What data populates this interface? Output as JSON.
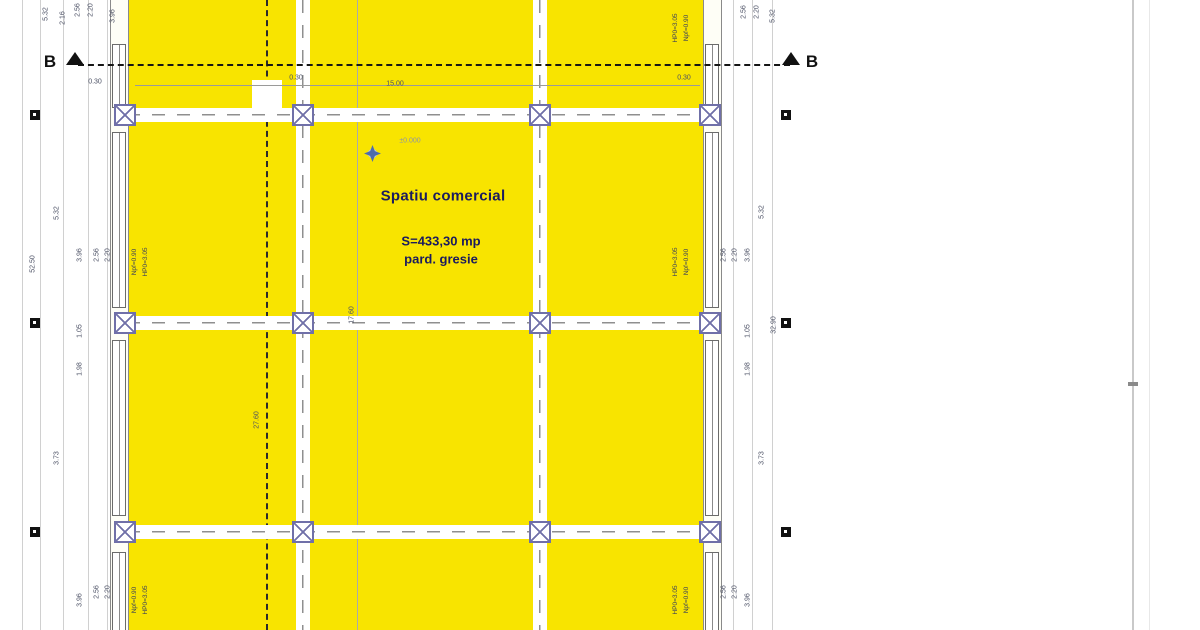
{
  "drawing": {
    "type": "architectural floor plan",
    "colors": {
      "room_fill": "#f8e400",
      "column_stroke": "#7070a8",
      "label_navy": "#1b1b5e",
      "dim_text": "#4a4f63",
      "marker_black": "#111111"
    }
  },
  "section": {
    "label": "B"
  },
  "room": {
    "name": "Spatiu comercial",
    "area": "S=433,30 mp",
    "flooring": "pard. gresie",
    "level": "±0.000"
  },
  "dims": {
    "overall_left": "52.50",
    "overall_right": "32.90",
    "span_top": "15.00",
    "bay_532": "5.32",
    "bay_396": "3.96",
    "bay_105": "1.05",
    "bay_198": "1.98",
    "bay_373": "3.73",
    "bay_216": "2.16",
    "win_w": "2.56",
    "win_h": "2.20",
    "off_030": "0.30",
    "int_1760": "17.60",
    "int_2760": "27.60"
  },
  "window_note": {
    "parapet": "Npf=0.90",
    "header": "HP0=3.05"
  }
}
